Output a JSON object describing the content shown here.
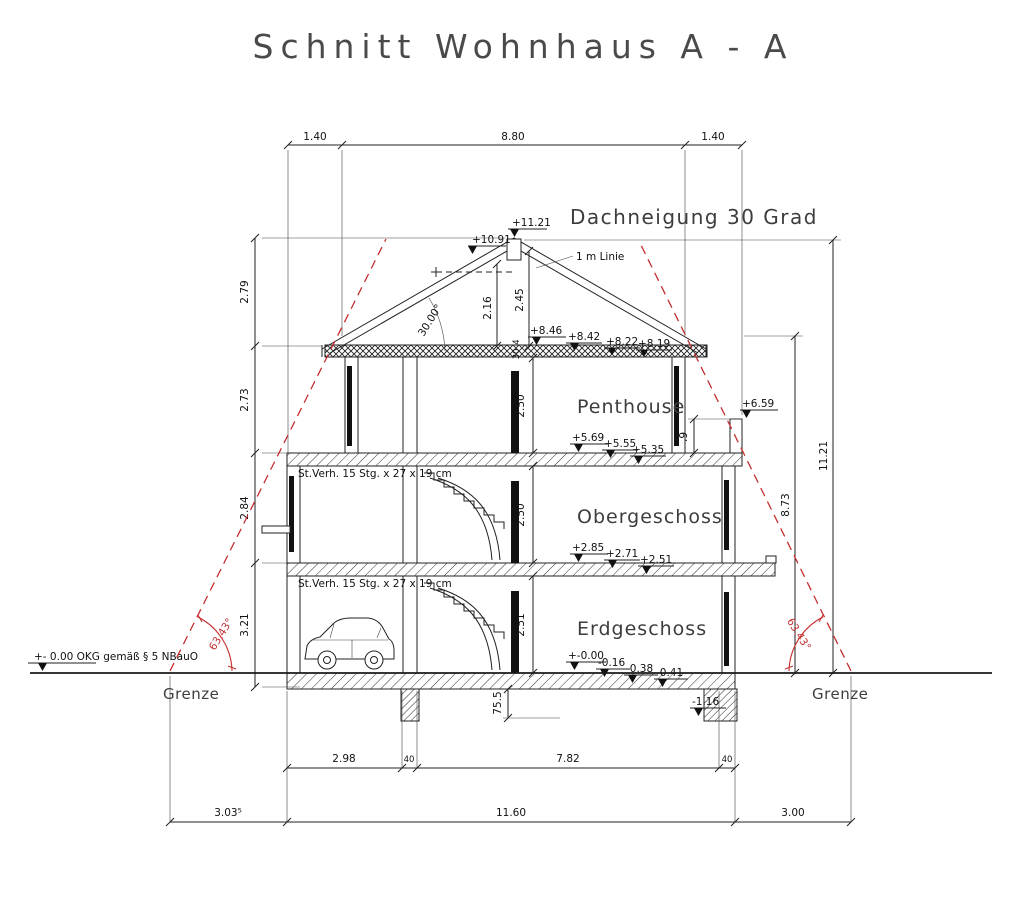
{
  "title": "Schnitt Wohnhaus A - A",
  "texts": {
    "roof_pitch": "Dachneigung 30 Grad",
    "roof_angle": "30.00°",
    "one_m": "1 m Linie",
    "ground_note": "+- 0.00 OKG gemäß § 5 NBauO",
    "grenze_left": "Grenze",
    "grenze_right": "Grenze",
    "angle_left": "63.43°",
    "angle_right": "63.43°",
    "stair_upper": "St.Verh. 15 Stg.  x 27 x 19 cm",
    "stair_lower": "St.Verh. 15 Stg.  x 27 x 19 cm"
  },
  "rooms": {
    "penthouse": "Penthouse",
    "og": "Obergeschoss",
    "eg": "Erdgeschoss"
  },
  "levels": {
    "ridge": "+11.21",
    "ridge_lower": "+10.91",
    "eave": [
      "+8.46",
      "+8.42",
      "+8.22",
      "+8.19"
    ],
    "terrace": "+6.59",
    "penthouse_floor": [
      "+5.69",
      "+5.55",
      "+5.35"
    ],
    "og_floor": [
      "+2.85",
      "+2.71",
      "+2.51"
    ],
    "eg_floor": [
      "+-0.00",
      "-0.16",
      "-0.38",
      "-0.41"
    ],
    "foundation": "-1.16"
  },
  "dims": {
    "top": [
      "1.40",
      "8.80",
      "1.40"
    ],
    "left_chain": [
      "2.79",
      "2.73",
      "2.84",
      "3.21"
    ],
    "right_eave": "8.73",
    "right_total": "11.21",
    "roof_inner": [
      "2.16",
      "2.45"
    ],
    "slab_edge": [
      "4",
      "30"
    ],
    "floor_heights": [
      "2.50",
      "2.50",
      "2.51"
    ],
    "parapet": ".9",
    "foundation_depth": "75.5",
    "bottom_inner": [
      "2.98",
      "40",
      "7.82",
      "40"
    ],
    "bottom_outer": [
      "3.03⁵",
      "11.60",
      "3.00"
    ]
  },
  "colors": {
    "line": "#222222",
    "red_accent": "#c52f2f",
    "background": "#ffffff"
  }
}
